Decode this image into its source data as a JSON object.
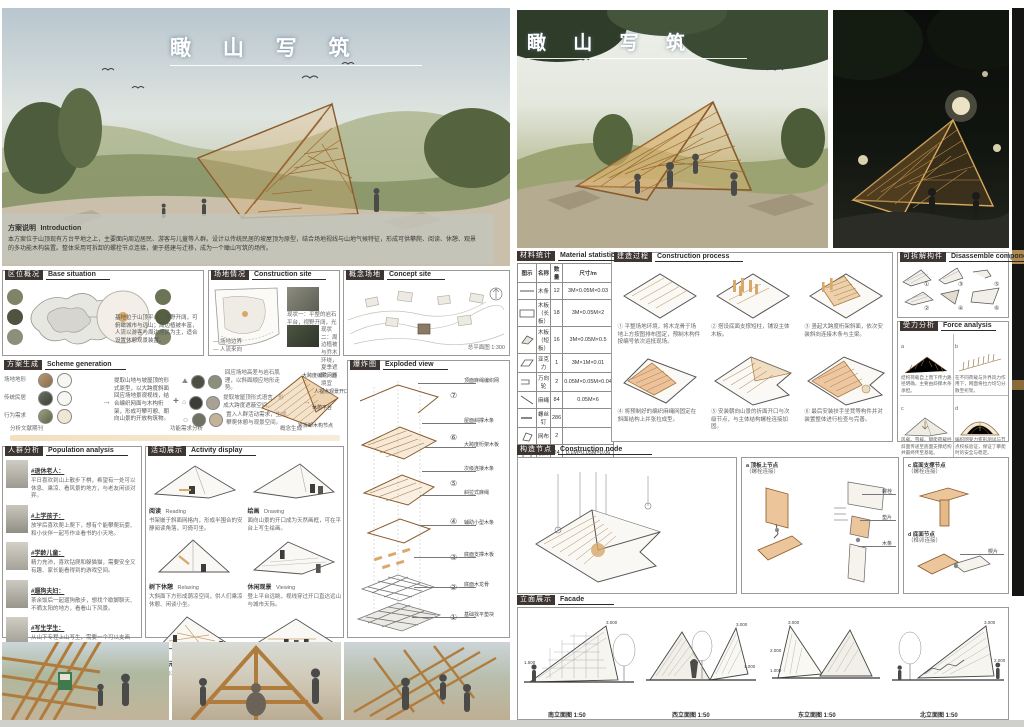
{
  "poster": {
    "title": "瞰 山 写 筑",
    "bottom_strip_note": ""
  },
  "left": {
    "intro": {
      "zh": "方案说明",
      "en": "Introduction",
      "text": "本方案位于山顶现有方台平地之上，主要面向周边居民、游客与儿童等人群。设计以传统民居的坡屋顶为原型，结合场地视线与山地气候特征，形成可供攀爬、阅读、休憩、观景的多功能木构装置。整体采用可拆卸的螺栓节点连接，便于搭建与迁移，成为一个瞰山写筑的场所。"
    },
    "sections": {
      "base": {
        "zh": "区位概况",
        "en": "Base situation",
        "note": "基地位于山顶平台，视野开阔，可俯瞰城市与远山；周边植被丰富，人流以游客与周边居民为主，适合设置休憩观景装置。"
      },
      "site": {
        "zh": "场地情况",
        "en": "Construction site",
        "cap1": "现状一：平整的岩石平台，视野开阔，光照充足。",
        "cap2": "现状二：周边植被与乔木环绕，夏季遮阴，环境宜人。",
        "legend1": "— 场地边界",
        "legend2": "— 人流来向"
      },
      "concept": {
        "zh": "概念场地",
        "en": "Concept site",
        "scale": "总平面图 1:300",
        "north": "N"
      },
      "scheme": {
        "zh": "方案生成",
        "en": "Scheme generation"
      },
      "population": {
        "zh": "人群分析",
        "en": "Population analysis"
      },
      "activity": {
        "zh": "活动展示",
        "en": "Activity display"
      },
      "exploded": {
        "zh": "爆炸图",
        "en": "Exploded view"
      }
    },
    "scheme": {
      "inputs": [
        "场地地形",
        "传统民居",
        "行为需求"
      ],
      "paragraph": "提取山地与坡屋顶的形式原型，以大跨度斜面回应场地景观视线，结合编织网面与木构桁架，形成可攀可憩、朝向山景的开放构筑物。",
      "plus": "+",
      "arrow": "→",
      "pairs": [
        {
          "caption": "回应场地高差与岩石肌理，以斜面顺应地形走势。"
        },
        {
          "caption": "提取坡屋顶形式语言，形成大跨度遮蔽空间。"
        },
        {
          "caption": "置入人群活动需求，生成攀爬休憩与观景空间。"
        }
      ],
      "result_labels": [
        "大跨度编织网面",
        "人视点观景开口",
        "休憩平台",
        "可拆卸木构节点"
      ],
      "timeline": [
        "分析文献期刊",
        "功能需求分析",
        "概念生成"
      ]
    },
    "population": {
      "groups": [
        {
          "name": "#退休老人：",
          "desc": "平日喜欢到山上散步下棋，希望有一处可以休息、乘凉、看风景的地方，与老友闲谈对弈。"
        },
        {
          "name": "#上学孩子：",
          "desc": "放学后喜欢爬上爬下，想有个能攀爬玩耍、和小伙伴一起写作业看书的小天地。"
        },
        {
          "name": "#学龄儿童：",
          "desc": "精力充沛，喜欢钻爬和躲猫猫，需要安全又有趣、家长能看得到的游戏空间。"
        },
        {
          "name": "#遛狗夫妇：",
          "desc": "茶余饭后一起遛狗散步，想找个歇脚聊天、不晒太阳的地方，看看山下风景。"
        },
        {
          "name": "#写生学生：",
          "desc": "从山下专程上山写生，需要一个可以支画架、观山取景、遮阳避雨的平台。"
        }
      ]
    },
    "activity": {
      "items": [
        {
          "num": "1",
          "zh": "阅读",
          "en": "Reading",
          "note": "书架嵌于斜面网格内，形成半围合的安静阅读角落，可倚可坐。"
        },
        {
          "num": "2",
          "zh": "绘画",
          "en": "Drawing",
          "note": "面向山景的开口成为天然画框，可在平台上写生绘画。"
        },
        {
          "num": "3",
          "zh": "树下休憩",
          "en": "Relaxing",
          "note": "大斜面下方形成荫凉空间，供人们乘凉休憩、闲谈小坐。"
        },
        {
          "num": "4",
          "zh": "休闲观景",
          "en": "Viewing",
          "note": "登上平台远眺，视线穿过开口直达远山与城市天际。"
        },
        {
          "num": "5",
          "zh": "儿童游玩",
          "en": "Kids Playing",
          "note": "编织网与木格构成攀爬面，成为儿童的游乐场。"
        },
        {
          "num": "6",
          "zh": "手工课堂",
          "en": "Fun Build",
          "note": "装置可拆解重组，成为户外木工与搭建课堂。"
        }
      ]
    },
    "exploded": {
      "numbers": [
        "⑦",
        "⑥",
        "⑤",
        "④",
        "③",
        "②",
        "①"
      ],
      "labels": [
        "顶面麻绳编织网",
        "屋面斜撑木条",
        "大跨度桁架木板",
        "次级连接木条",
        "斜拉式麻绳",
        "辅助小型木条",
        "底面支撑木板",
        "底面木龙骨",
        "基础找平垫块"
      ]
    }
  },
  "right": {
    "sections": {
      "material": {
        "zh": "材料统计",
        "en": "Material statistics"
      },
      "process": {
        "zh": "建造过程",
        "en": "Construction process"
      },
      "components": {
        "zh": "可拆解构件",
        "en": "Disassemble components"
      },
      "force": {
        "zh": "受力分析",
        "en": "Force analysis"
      },
      "node": {
        "zh": "构造节点",
        "en": "Construction node"
      },
      "facade": {
        "zh": "立面展示",
        "en": "Facade"
      }
    },
    "material": {
      "headers": [
        "图示",
        "名称",
        "数量",
        "尺寸/m"
      ],
      "rows": [
        {
          "name": "木条",
          "qty": "12",
          "size": "3M×0.05M×0.03"
        },
        {
          "name": "木板（长板）",
          "qty": "18",
          "size": "3M×0.05M×2"
        },
        {
          "name": "木板（短板）",
          "qty": "16",
          "size": "3M×0.05M×0.5"
        },
        {
          "name": "亚克力",
          "qty": "1",
          "size": "3M×1M×0.01"
        },
        {
          "name": "万向轮",
          "qty": "2",
          "size": "0.05M×0.05M×0.04"
        },
        {
          "name": "麻绳",
          "qty": "84",
          "size": "0.05M×6"
        },
        {
          "name": "螺丝钉",
          "qty": "286",
          "size": ""
        },
        {
          "name": "网布",
          "qty": "2",
          "size": ""
        },
        {
          "name": "楔片",
          "qty": "24",
          "size": "0.1M×0.05M×0.06"
        }
      ]
    },
    "process": {
      "steps": [
        "① 平整场地环境，将木龙骨于场地上方按图排布固定，预制木构件按编号依次运抵现场。",
        "② 搭设底面支撑短柱，铺设主体木板。",
        "③ 竖起大跨度桁架斜面，依次安装斜向连接木条与主梁。",
        "④ 将预制好的编织麻绳网固定在斜面结构上并张拉成型。",
        "⑤ 安装朝向山景的折面开口与次级节点，与主体结构螺栓连接加固。",
        "⑥ 最后安装扶手坐凳等构件并对装置整体进行检查与完善。"
      ]
    },
    "components": {
      "nums": [
        "①",
        "②",
        "③",
        "④",
        "⑤",
        "⑥"
      ]
    },
    "force": {
      "items": [
        {
          "tag": "a",
          "text": "结构荷载自上而下传力路径明确，主要由斜撑木条承担。"
        },
        {
          "tag": "b",
          "text": "在不同荷载与外界风力作用下，网面将拉力均匀分散至桁架。"
        },
        {
          "tag": "c",
          "text": "风载、雪载、攀爬荷载经斜面传递至底面支撑结构并最终传至基础。"
        },
        {
          "tag": "d",
          "text": "编织网受力变形测试与节点校核验证，保证了攀爬时的安全与稳定。"
        }
      ]
    },
    "node": {
      "details": [
        {
          "tag": "a 顶板上节点",
          "sub": "（螺栓连接）"
        },
        {
          "tag": "b 顶板下节点",
          "sub": "（螺栓连接）"
        },
        {
          "tag": "c 底面支撑节点",
          "sub": "（螺栓连接）"
        },
        {
          "tag": "d 底面节点",
          "sub": "（榫卯连接）"
        }
      ],
      "parts": [
        "螺栓",
        "垫片",
        "万向轮",
        "木条",
        "楔片",
        "麻绳"
      ]
    },
    "facade": {
      "elevations": [
        "南立面图 1:50",
        "西立面图 1:50",
        "东立面图 1:50",
        "北立面图 1:50"
      ],
      "levels": [
        "3.000",
        "2.000",
        "1.000",
        "±0.000"
      ]
    }
  }
}
